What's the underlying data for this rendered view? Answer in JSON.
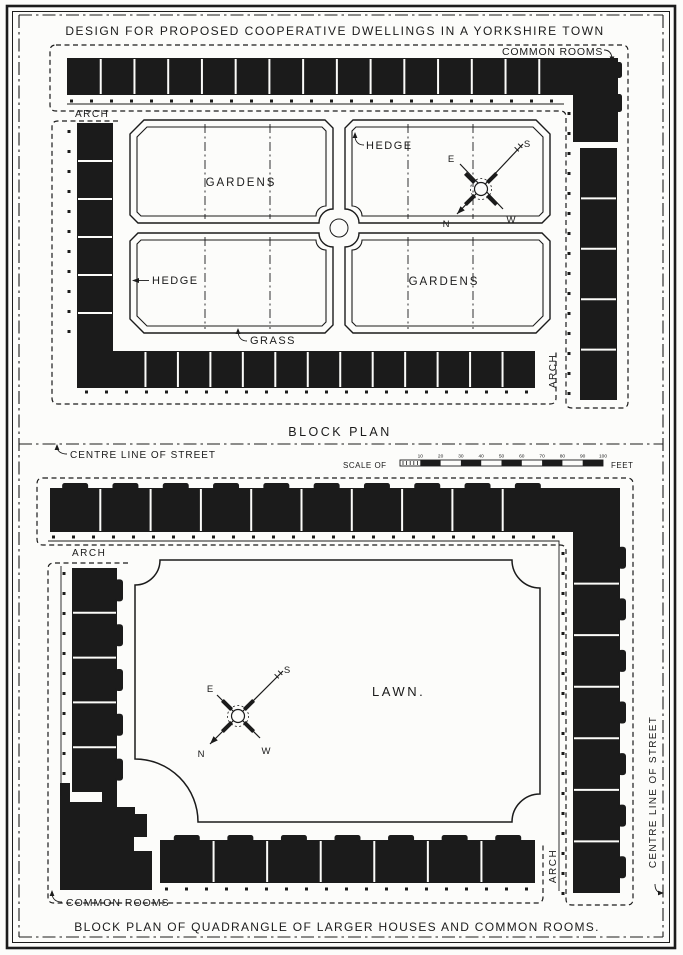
{
  "page": {
    "title": "DESIGN FOR PROPOSED COOPERATIVE DWELLINGS IN A YORKSHIRE TOWN"
  },
  "top_plan": {
    "caption": "BLOCK PLAN",
    "common_rooms_label": "COMMON ROOMS",
    "arch_top_label": "ARCH",
    "arch_right_label": "ARCH",
    "gardens_upper_label": "GARDENS",
    "gardens_lower_label": "GARDENS",
    "hedge_upper_label": "HEDGE",
    "hedge_lower_label": "HEDGE",
    "grass_label": "GRASS",
    "compass": {
      "n": "N",
      "e": "E",
      "s": "S",
      "w": "W"
    },
    "house_counts": {
      "top_row": 15,
      "bottom_row": 13,
      "left_col": 6,
      "right_col": 5
    }
  },
  "streets": {
    "left_label": "CENTRE LINE OF STREET",
    "right_label": "CENTRE LINE OF STREET"
  },
  "scale_bar": {
    "prefix": "SCALE OF",
    "suffix": "FEET",
    "ticks": [
      10,
      20,
      30,
      40,
      50,
      60,
      70,
      80,
      90,
      100
    ]
  },
  "bottom_plan": {
    "caption": "BLOCK PLAN OF QUADRANGLE OF LARGER HOUSES AND COMMON ROOMS.",
    "common_rooms_label": "COMMON ROOMS",
    "arch_top_label": "ARCH",
    "arch_right_label": "ARCH",
    "lawn_label": "LAWN.",
    "compass": {
      "n": "N",
      "e": "E",
      "s": "S",
      "w": "W"
    },
    "house_counts": {
      "top_row": 10,
      "bottom_row": 7,
      "left_col": 5,
      "right_col": 7
    }
  },
  "colors": {
    "ink": "#1b1b1b",
    "paper": "#fcfcfa"
  }
}
